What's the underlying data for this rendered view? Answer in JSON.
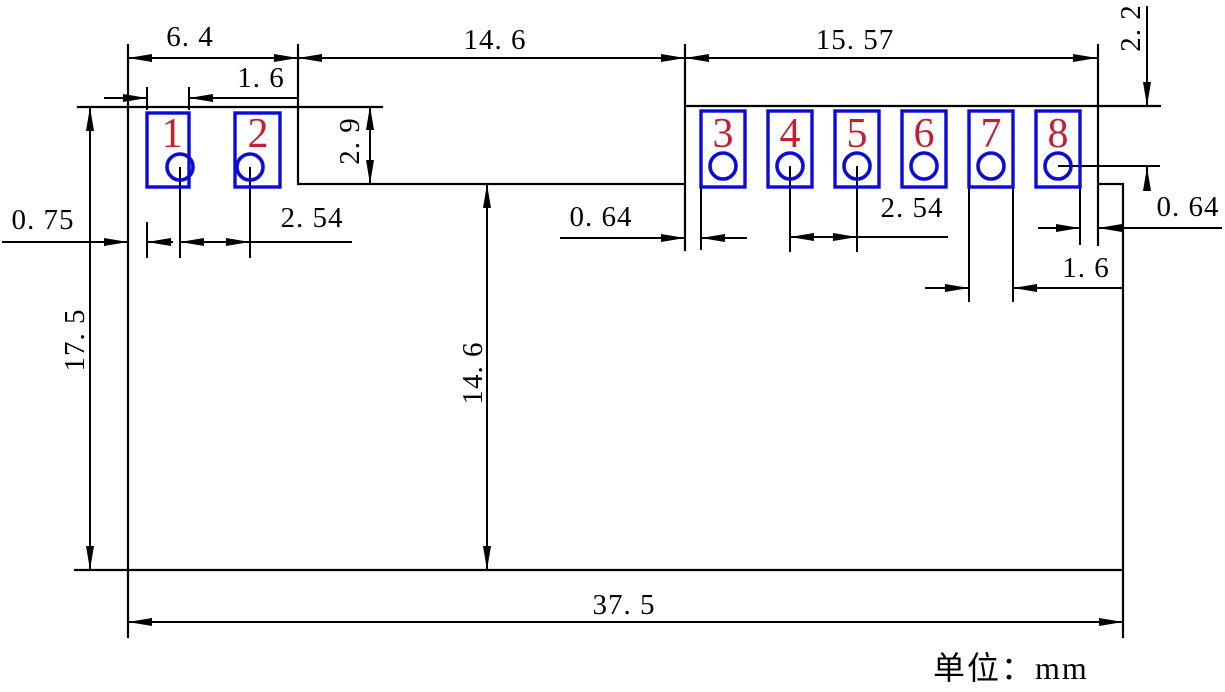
{
  "drawing": {
    "unit_label": "单位：mm",
    "pads": [
      {
        "number": "1"
      },
      {
        "number": "2"
      },
      {
        "number": "3"
      },
      {
        "number": "4"
      },
      {
        "number": "5"
      },
      {
        "number": "6"
      },
      {
        "number": "7"
      },
      {
        "number": "8"
      }
    ],
    "dimensions": {
      "left_section_width": "6. 4",
      "pad1_width": "1. 6",
      "notch_width": "14. 6",
      "right_section_width": "15. 57",
      "top_edge_to_hole": "2. 2",
      "left_edge_to_pad": "0. 75",
      "hole_pitch_left": "2. 54",
      "notch_depth": "2. 9",
      "notch_to_pad3": "0. 64",
      "hole_pitch_right": "2. 54",
      "pad8_to_right_edge": "0. 64",
      "pad7_width": "1. 6",
      "body_height": "17. 5",
      "notch_to_bottom": "14. 6",
      "body_width": "37. 5"
    },
    "colors": {
      "line": "#000000",
      "pad_outline": "#0b0bd8",
      "pad_number": "#c21f30",
      "background": "#ffffff"
    }
  }
}
